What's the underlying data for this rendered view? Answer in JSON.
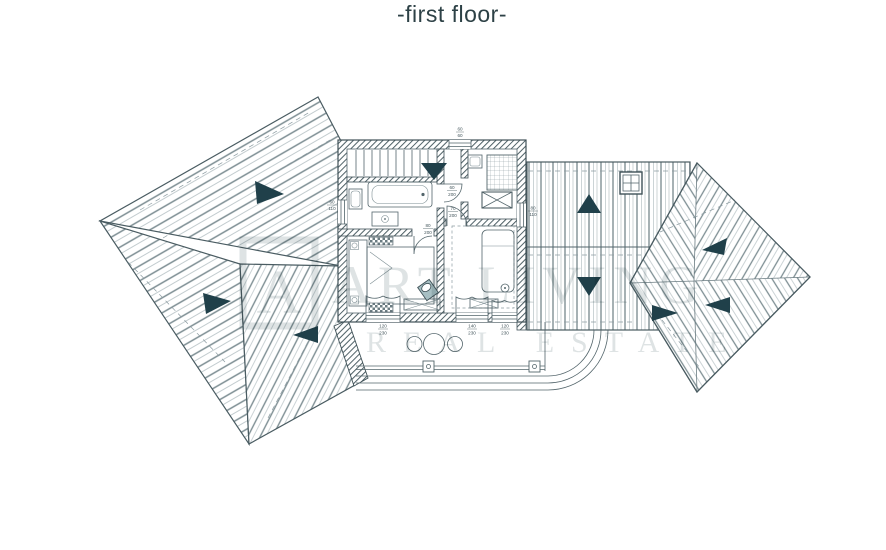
{
  "title": "-first floor-",
  "watermark": {
    "logo_letter": "A",
    "line1": "ART LIVING",
    "line2": "REAL ESTATE"
  },
  "labels": {
    "window_top": {
      "w": "60",
      "h": "60"
    },
    "window_left": {
      "w": "60",
      "h": "110"
    },
    "window_right": {
      "w": "80",
      "h": "110"
    },
    "door_bath": {
      "w": "60",
      "h": "200"
    },
    "door_wc": {
      "w": "70",
      "h": "200"
    },
    "door_bedroom1": {
      "w": "80",
      "h": "200"
    },
    "door_balcony_left": {
      "w": "120",
      "h": "230"
    },
    "door_balcony_center": {
      "w": "140",
      "h": "230"
    },
    "door_balcony_right": {
      "w": "120",
      "h": "230"
    }
  },
  "colors": {
    "ink": "#53656b",
    "outline": "#3f5157",
    "accent": "#20404a",
    "watermark": "#d9dedf",
    "title": "#2d4146",
    "background": "#ffffff"
  }
}
